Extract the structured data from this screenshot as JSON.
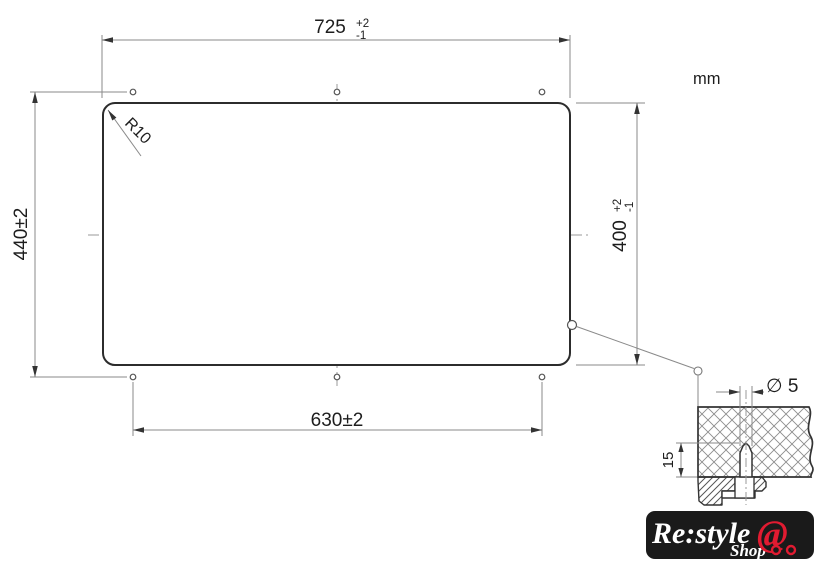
{
  "unit_label": "mm",
  "main_view": {
    "cutout_width": {
      "value": "725",
      "tol_plus": "+2",
      "tol_minus": "-1"
    },
    "cutout_height": {
      "value": "400",
      "tol_plus": "+2",
      "tol_minus": "-1"
    },
    "hole_span_horizontal": "630±2",
    "hole_span_vertical": "440±2",
    "corner_radius_label": "R10"
  },
  "detail_view": {
    "hole_diameter_label": "∅ 5",
    "hole_depth_label": "15"
  },
  "logo": {
    "brand": "Re:style",
    "sub_brand": "Shop",
    "cart_symbol": "@"
  },
  "colors": {
    "object_line": "#2c2c2c",
    "dimension_line": "#8a8a8a",
    "text": "#1d1d1d",
    "logo_background": "#1a1a1a",
    "logo_red": "#e11b31"
  }
}
